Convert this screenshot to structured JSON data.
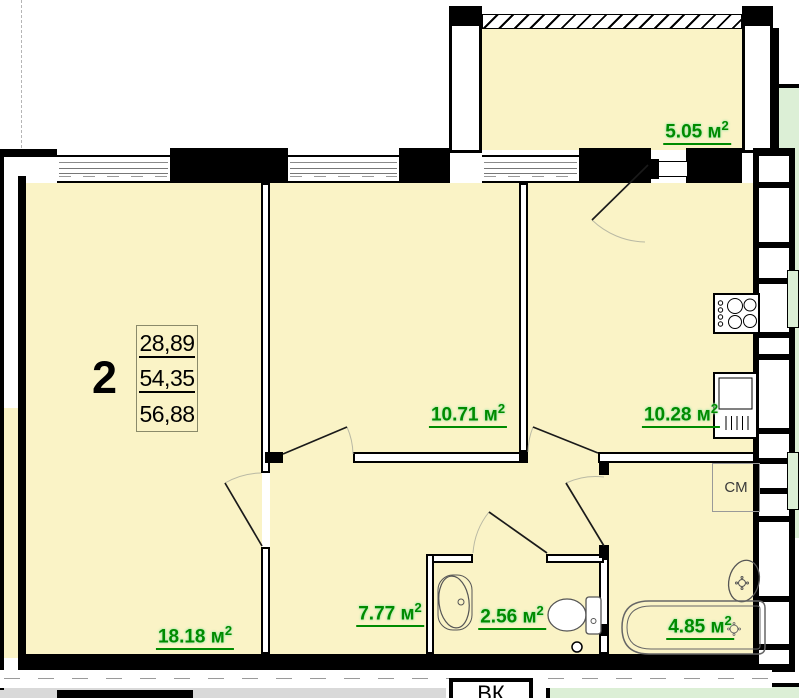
{
  "apartment_info": {
    "rooms_count": "2",
    "area_lines": [
      "28,89",
      "54,35",
      "56,88"
    ]
  },
  "areas": {
    "balcony": {
      "value": "5.05",
      "unit": "м",
      "sup": "2"
    },
    "bedroom": {
      "value": "10.71",
      "unit": "м",
      "sup": "2"
    },
    "kitchen": {
      "value": "10.28",
      "unit": "м",
      "sup": "2"
    },
    "living_room": {
      "value": "18.18",
      "unit": "м",
      "sup": "2"
    },
    "hallway": {
      "value": "7.77",
      "unit": "м",
      "sup": "2"
    },
    "wc": {
      "value": "2.56",
      "unit": "м",
      "sup": "2"
    },
    "bathroom": {
      "value": "4.85",
      "unit": "м",
      "sup": "2"
    }
  },
  "labels": {
    "washing_machine": "СМ",
    "ventilation": "ВК"
  },
  "colors": {
    "room_fill": "#FAF3C6",
    "area_text": "#008B00",
    "neighbor_fill": "#DCEFD6",
    "outside_gray": "#D9D9D9",
    "wall": "#000000"
  }
}
